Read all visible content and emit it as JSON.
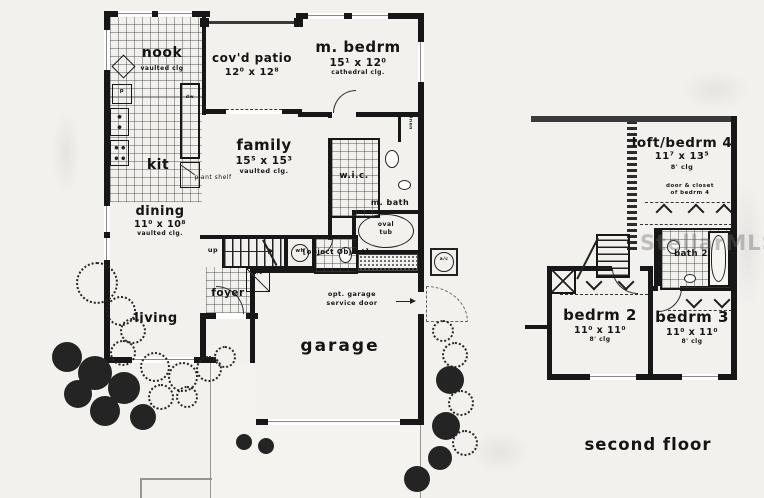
{
  "watermark": "StellarMLS",
  "first_floor": {
    "nook": {
      "label": "nook",
      "clg": "vaulted clg"
    },
    "patio": {
      "label": "cov'd patio",
      "dims": "12⁰ x 12⁸"
    },
    "mbedrm": {
      "label": "m. bedrm",
      "dims": "15¹ x 12⁰",
      "clg": "cathedral clg."
    },
    "kit": {
      "label": "kit"
    },
    "family": {
      "label": "family",
      "dims": "15⁵ x 15³",
      "clg": "vaulted clg."
    },
    "dining": {
      "label": "dining",
      "dims": "11⁰ x 10⁸",
      "clg": "vaulted clg."
    },
    "living": {
      "label": "living"
    },
    "foyer": {
      "label": "foyer"
    },
    "garage": {
      "label": "garage"
    },
    "wic": {
      "label": "w.i.c."
    },
    "mbath": {
      "label": "m. bath"
    },
    "powder": {
      "label": "powder"
    },
    "oval_tub": {
      "line1": "oval",
      "line2": "tub"
    },
    "wh": "wh",
    "ac": "a/c",
    "linen": "linen",
    "plant_shelf": "plant shelf",
    "up": "up",
    "dw": "dw",
    "pantry": "p",
    "service_note": {
      "line1": "opt. garage",
      "line2": "service door"
    }
  },
  "second_floor": {
    "loft": {
      "label": "loft/bedrm 4",
      "dims": "11⁷ x 13⁵",
      "clg": "8' clg"
    },
    "closet_note": {
      "line1": "door & closet",
      "line2": "of bedrm 4"
    },
    "bath2": "bath 2",
    "bedrm2": {
      "label": "bedrm 2",
      "dims": "11⁰ x 11⁰",
      "clg": "8' clg"
    },
    "bedrm3": {
      "label": "bedrm 3",
      "dims": "11⁰ x 11⁰",
      "clg": "8' clg"
    },
    "caption": "second floor"
  }
}
